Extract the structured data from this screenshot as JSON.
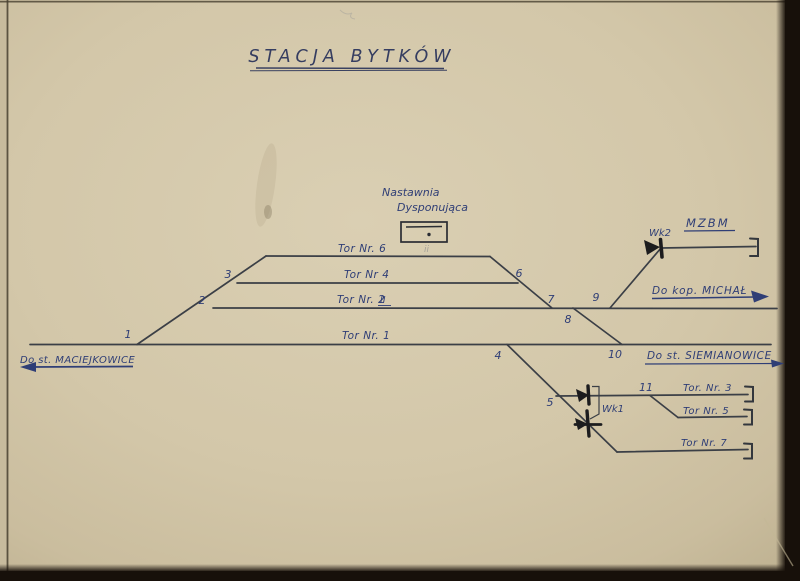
{
  "page": {
    "title": "STACJA BYTKÓW"
  },
  "signal_box": {
    "name_line1": "Nastawnia",
    "name_line2": "Dysponująca"
  },
  "routes": {
    "left_station": "Do st. MACIEJKOWICE",
    "right_station": "Do st. SIEMIANOWICE",
    "mine": "Do kop. MICHAŁ",
    "depot": "MZBM"
  },
  "tracks": {
    "t1": "Tor Nr. 1",
    "t2": "Tor Nr. 2",
    "t2_mark": "II",
    "t4": "Tor Nr 4",
    "t6": "Tor Nr. 6",
    "t6_mark": "ii",
    "t3": "Tor. Nr. 3",
    "t5": "Tor Nr. 5",
    "t7": "Tor Nr. 7"
  },
  "derailers": {
    "wk1": "Wk1",
    "wk2": "Wk2"
  },
  "junctions": [
    "1",
    "2",
    "3",
    "4",
    "5",
    "6",
    "7",
    "8",
    "9",
    "10",
    "11"
  ],
  "colors": {
    "paper": "#d3c7a9",
    "ink_blue": "#2f3e76",
    "ink_dark": "#3b3f46",
    "edge_dark": "#17100a"
  }
}
